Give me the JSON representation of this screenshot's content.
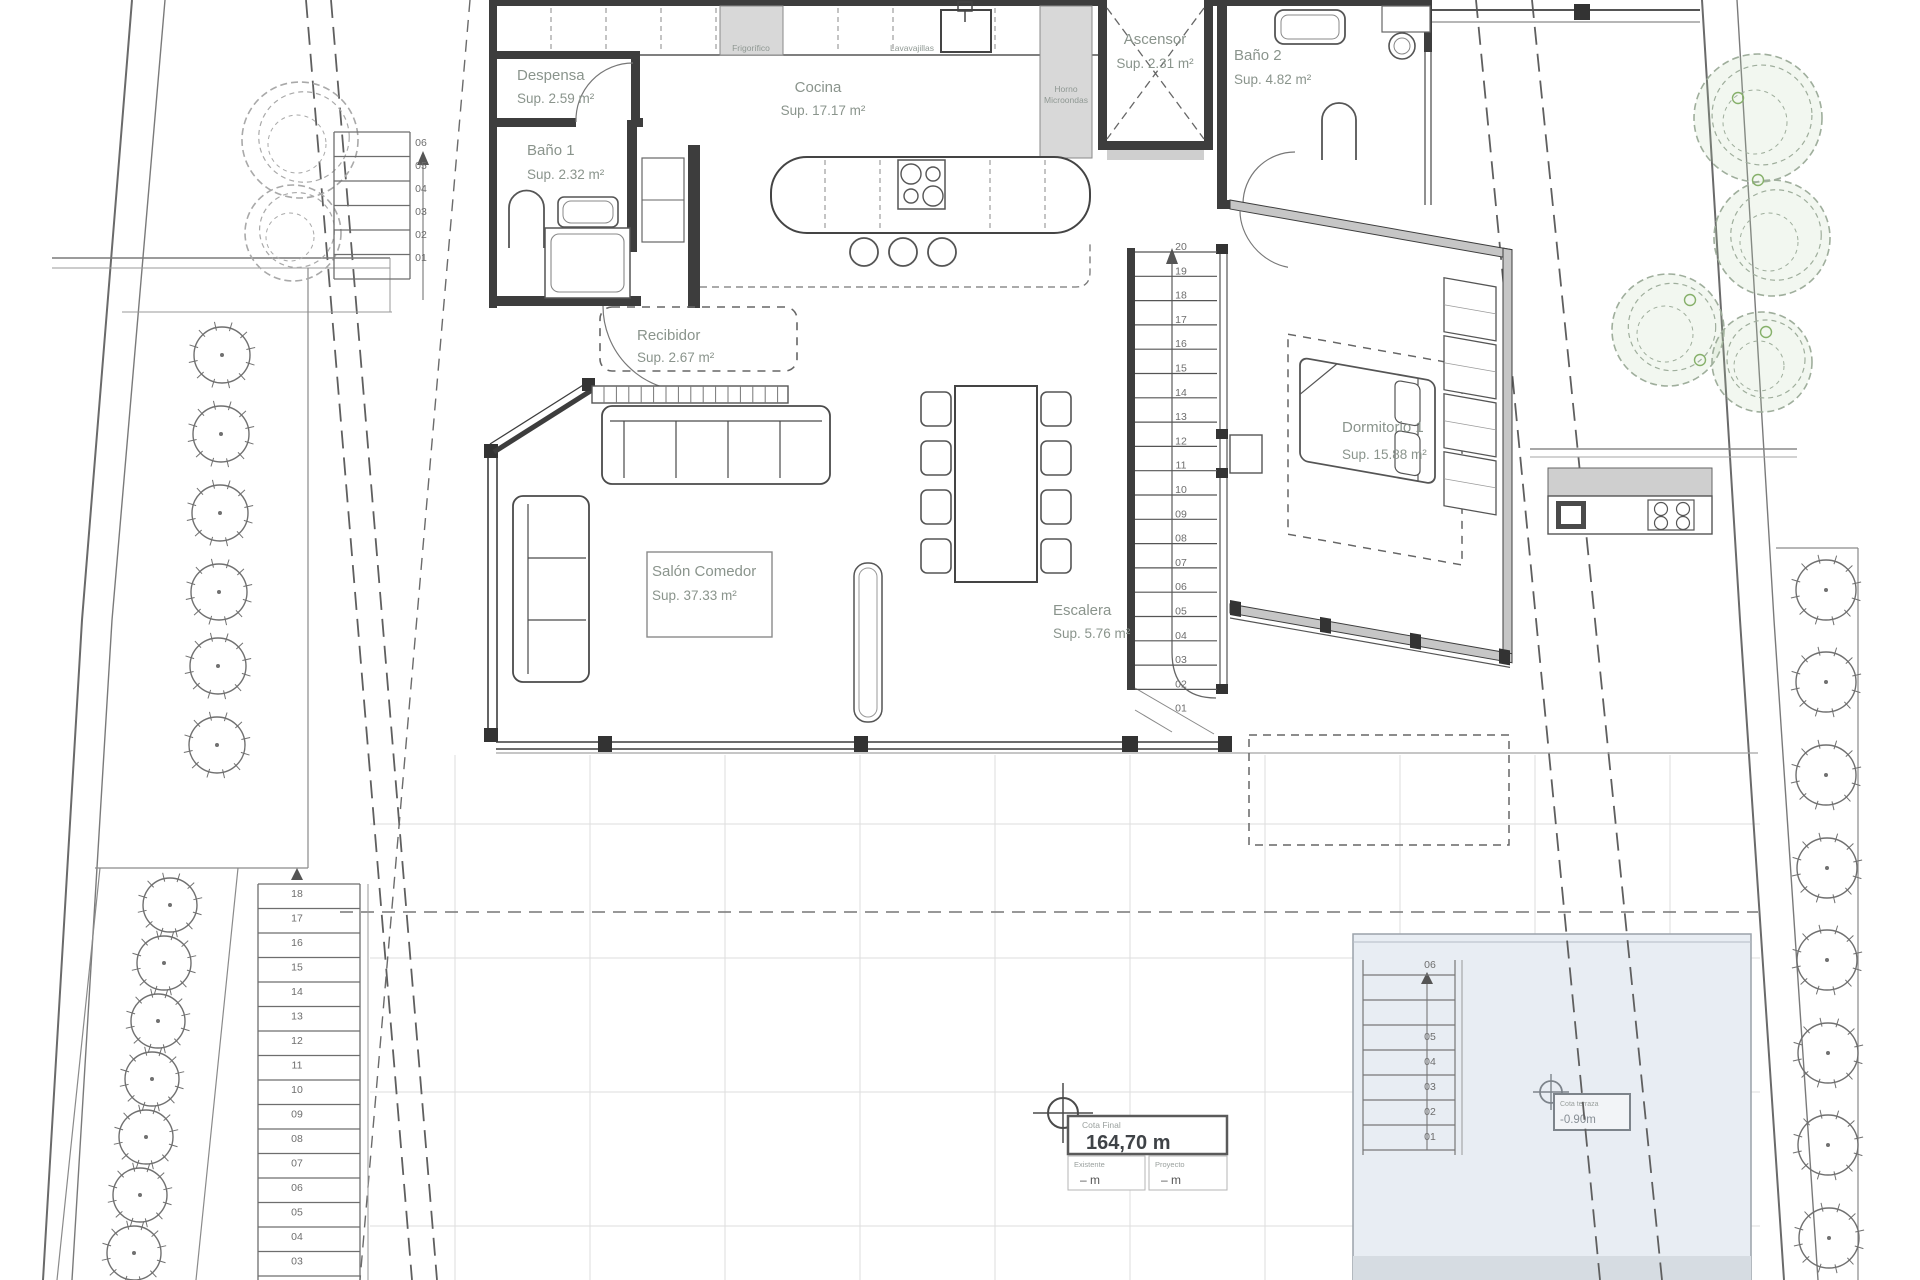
{
  "drawing": {
    "rooms": {
      "despensa": {
        "name": "Despensa",
        "area": "Sup. 2.59 m²"
      },
      "bano1": {
        "name": "Baño 1",
        "area": "Sup. 2.32 m²"
      },
      "cocina": {
        "name": "Cocina",
        "area": "Sup. 17.17 m²"
      },
      "ascensor": {
        "name": "Ascensor",
        "area": "Sup. 2.31 m²"
      },
      "bano2": {
        "name": "Baño 2",
        "area": "Sup. 4.82 m²"
      },
      "recibidor": {
        "name": "Recibidor",
        "area": "Sup. 2.67 m²"
      },
      "salon_comedor": {
        "name": "Salón Comedor",
        "area": "Sup. 37.33 m²"
      },
      "escalera": {
        "name": "Escalera",
        "area": "Sup. 5.76 m²"
      },
      "dormitorio1": {
        "name": "Dormitorio 1",
        "area": "Sup. 15.88 m²"
      }
    },
    "appliances": {
      "frigorifico": "Frigorífico",
      "lavavajillas": "Lavavajillas",
      "horno_line1": "Horno",
      "horno_line2": "Microondas"
    },
    "levels": {
      "main": {
        "title": "Cota Final",
        "value": "164,70 m",
        "left_label": "Existente",
        "left_value": "– m",
        "right_label": "Proyecto",
        "right_value": "– m"
      },
      "terrace": {
        "title": "Cota terraza",
        "value": "-0.90m"
      }
    },
    "stairs": {
      "main": [
        "20",
        "19",
        "18",
        "17",
        "16",
        "15",
        "14",
        "13",
        "12",
        "11",
        "10",
        "09",
        "08",
        "07",
        "06",
        "05",
        "04",
        "03",
        "02",
        "01"
      ],
      "exterior_left": [
        "18",
        "17",
        "16",
        "15",
        "14",
        "13",
        "12",
        "11",
        "10",
        "09",
        "08",
        "07",
        "06",
        "05",
        "04",
        "03"
      ],
      "entry": [
        "06",
        "05",
        "04",
        "03",
        "02",
        "01"
      ],
      "pool": [
        "06",
        "05",
        "04",
        "03",
        "02",
        "01"
      ]
    },
    "colors": {
      "label": "#8a948c",
      "wall": "#3d3d3d",
      "pool_fill": "#e8edf3",
      "tree_green": "#86b06a"
    }
  }
}
